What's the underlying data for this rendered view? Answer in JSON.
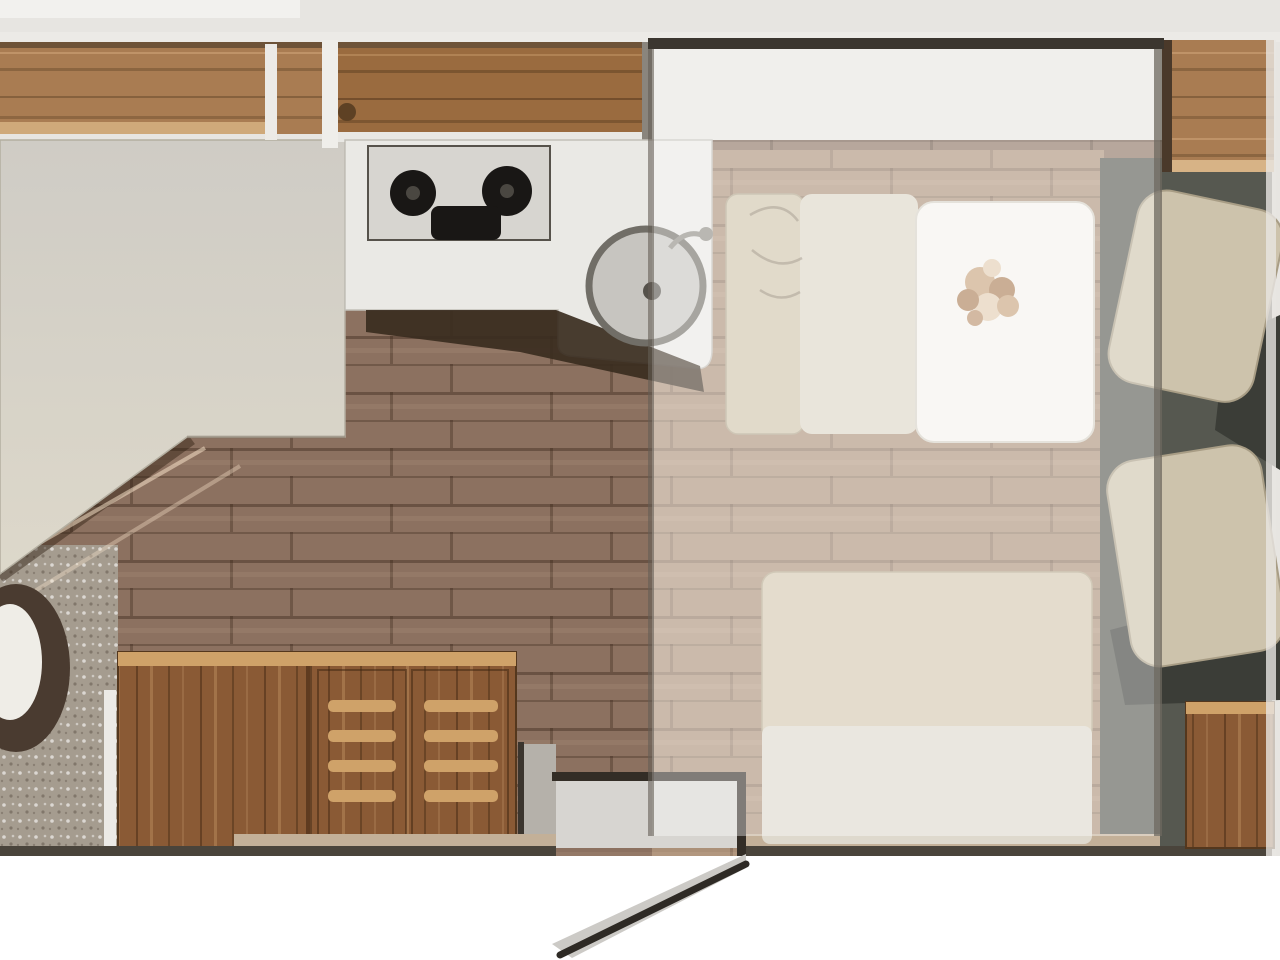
{
  "meta": {
    "type": "floorplan-image",
    "description": "Top-view floor plan of a caravan/motorhome interior with no text labels: rear double bed with angled foot and corner toilet at left, kitchen block with two-burner hob and round sink at top center, wooden sideboard and outward-swinging entry door on the bottom wall, dinette with table, flower bouquet and bench seats at right under a semi-transparent drop-down bed overlay, and two upholstered cab/lounge seats with corner wood cabinets at the far right."
  },
  "rooms": [
    {
      "name": "bedroom-rear"
    },
    {
      "name": "washroom-corner"
    },
    {
      "name": "kitchen"
    },
    {
      "name": "entry-corridor"
    },
    {
      "name": "dinette-lounge"
    },
    {
      "name": "cab-front"
    }
  ],
  "furniture": [
    {
      "name": "overhead-cabinets"
    },
    {
      "name": "double-bed"
    },
    {
      "name": "toilet"
    },
    {
      "name": "kitchen-counter"
    },
    {
      "name": "hob-two-burners"
    },
    {
      "name": "round-sink"
    },
    {
      "name": "wooden-sideboard"
    },
    {
      "name": "entry-door-open"
    },
    {
      "name": "dinette-bench-left"
    },
    {
      "name": "dinette-table-with-flowers"
    },
    {
      "name": "dinette-bench-bottom"
    },
    {
      "name": "drop-down-bed-overlay"
    },
    {
      "name": "cab-seat-upper"
    },
    {
      "name": "cab-seat-lower"
    },
    {
      "name": "corner-cabinet-top-right"
    },
    {
      "name": "corner-cabinet-bottom-right"
    }
  ],
  "colors": {
    "bg_top": "#e7e5e1",
    "bg_bottom": "#ffffff",
    "step_wedge": "#cbc8c3",
    "floor": "#8c7160",
    "floor_light": "#ab9078",
    "bath_floor": "#a59c8f",
    "cab_floor": "#565850",
    "wood_cabinet": "#a97c52",
    "wood_cabinet_dark": "#9a6b3f",
    "wood_cabinet_light": "#cfa97a",
    "sideboard": "#8a5a35",
    "sideboard_light": "#cfa269",
    "counter": "#eae9e5",
    "hob_panel": "#d7d5d0",
    "burner": "#191715",
    "counter_wedge": "#3a2c20",
    "sink_bowl": "#c7c5c0",
    "sink_ring": "#716e67",
    "bed_top": "#cfccc5",
    "bed_bottom": "#ddd8ca",
    "toilet_body": "#4a3b30",
    "toilet_seat": "#efede7",
    "bench": "#cfc3aa",
    "bench_light": "#dcd5c6",
    "bench_back": "#d3c7ae",
    "bench_seat": "#ded9cd",
    "table": "#f5f3ed",
    "flower_dark": "#aa7d55",
    "flower_mid": "#c7a27b",
    "flower_light": "#e2ccb1",
    "seat": "#cdc3ac",
    "seat_shadow": "#3b3d37",
    "wall_dark": "#4a443b",
    "wall_beige": "#c3b098",
    "door_leaf": "#cccac6",
    "door_line": "#2e2a25",
    "white_line": "#eceae6",
    "overlay_fill": "rgba(255,255,255,0.38)",
    "overlay_border": "#3b362f"
  }
}
